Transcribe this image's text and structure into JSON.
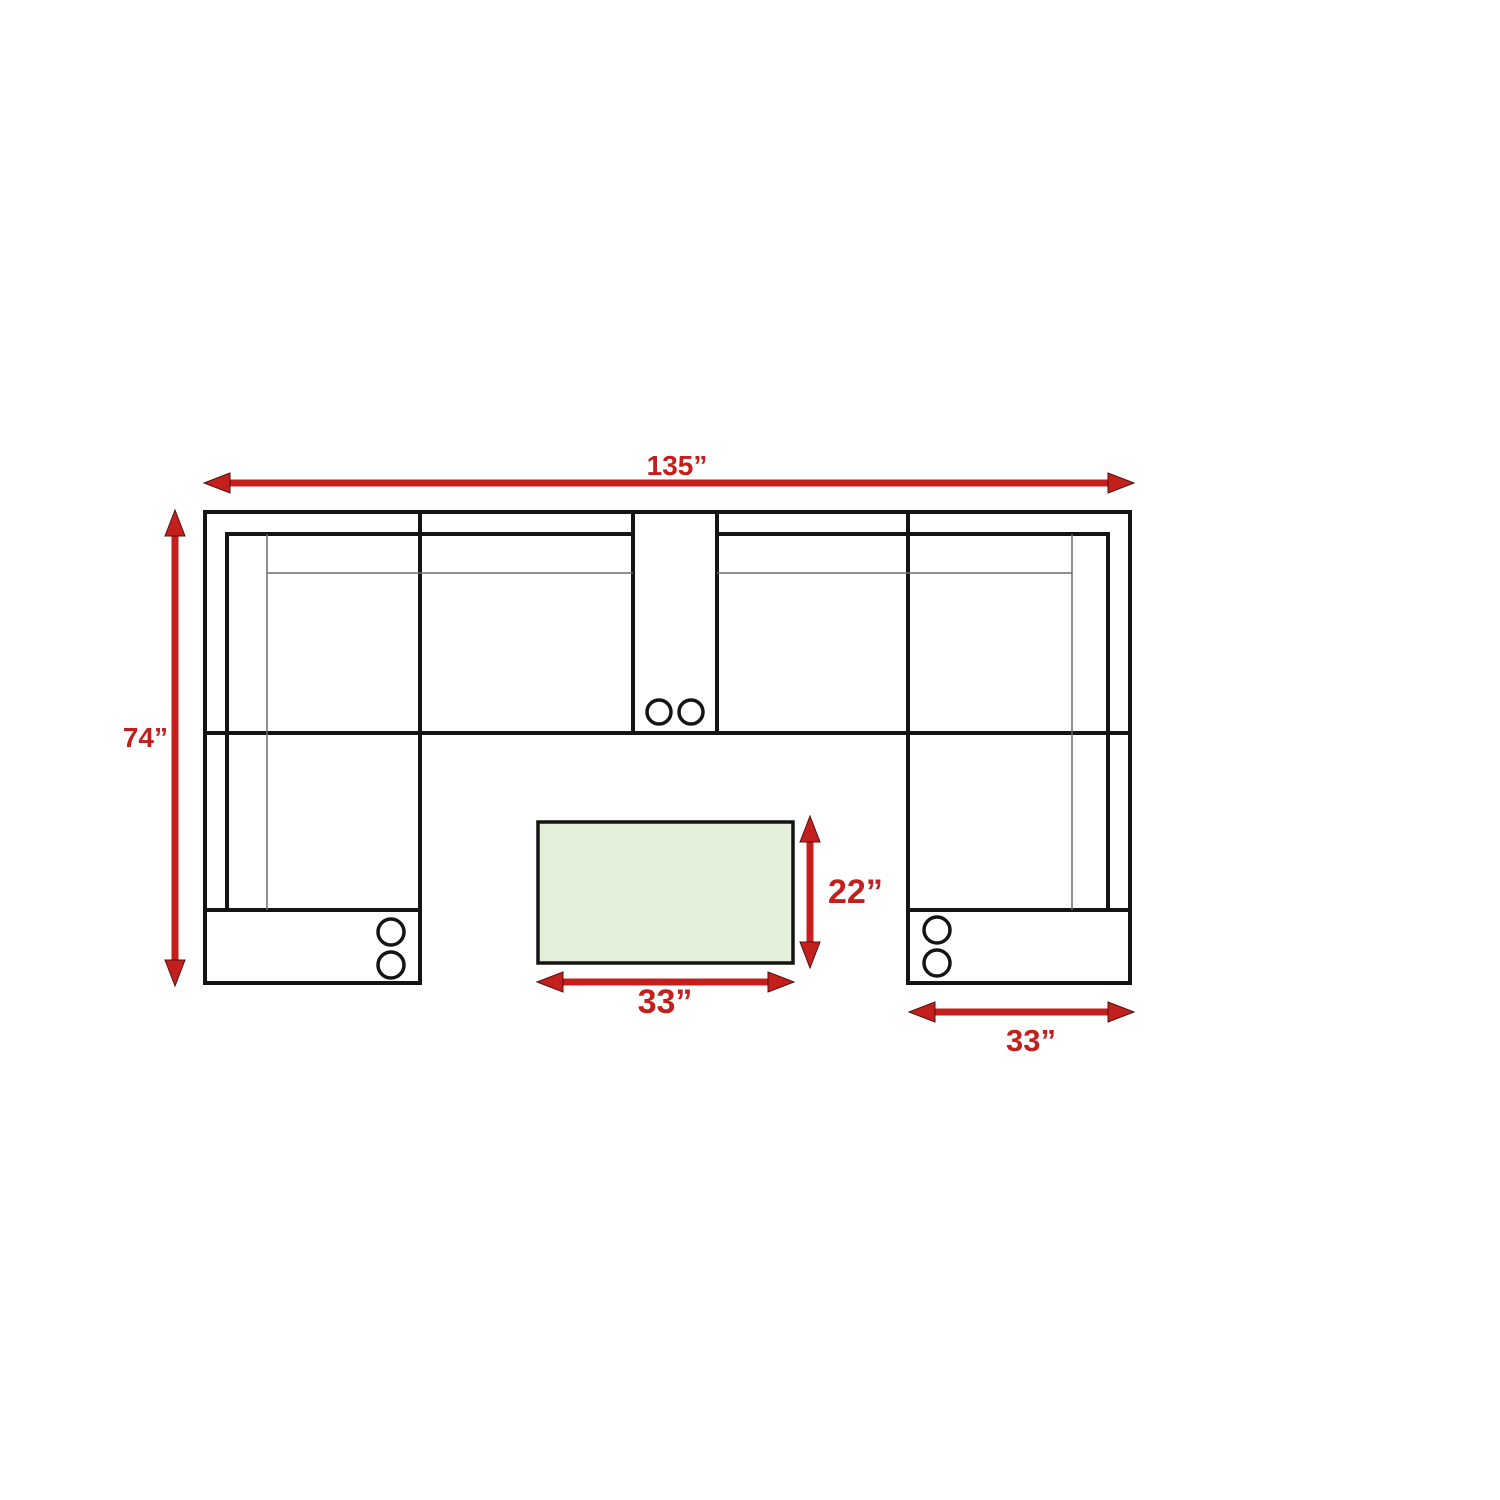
{
  "diagram": {
    "type": "floor-plan",
    "subject": "U-shaped sectional sofa top view with center console cup holders, storage arms and coffee table ottoman",
    "colors": {
      "dimension_red": "#c3201d",
      "outline_black": "#141414",
      "detail_gray": "#6b6b6b",
      "table_fill": "#e4efda",
      "background": "#ffffff"
    },
    "dimensions": {
      "overall_width": "135”",
      "overall_depth": "74”",
      "table_depth": "22”",
      "table_width": "33”",
      "right_chaise_width": "33”"
    }
  }
}
